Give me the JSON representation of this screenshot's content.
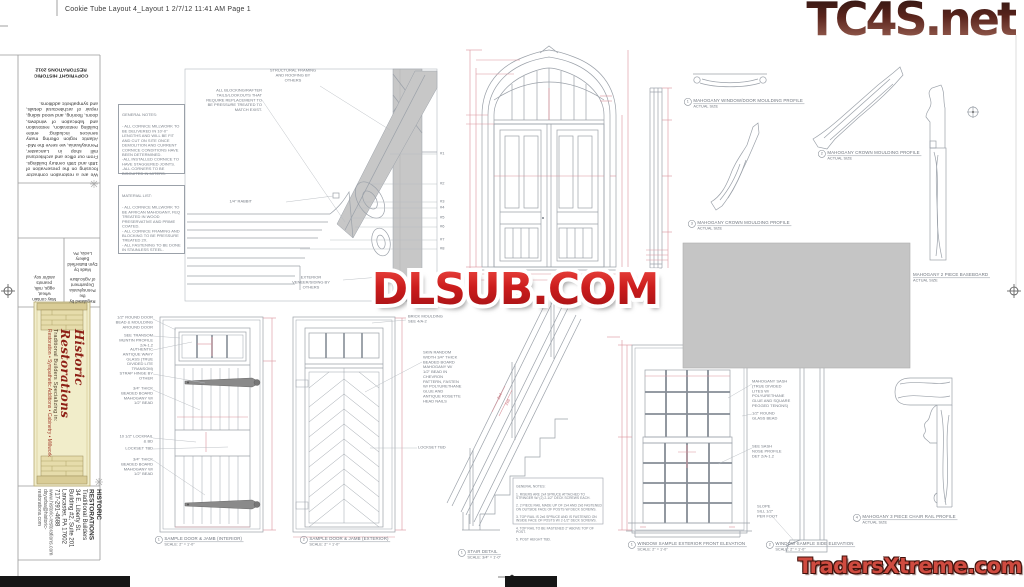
{
  "page": {
    "header": "Cookie Tube Layout 4_Layout 1  2/7/12  11:41 AM  Page 1"
  },
  "watermarks": {
    "tc4s": "TC4S.net",
    "dlsub": "DLSUB.COM",
    "traders": "TradersXtreme.com"
  },
  "sidebar": {
    "copyright": "COPYRIGHT HISTORIC\nRESTORATIONS 2012",
    "about": "We are a restoration contractor focusing on the preservation of 18th and 19th century buildings. From our office and architectural mill shop in Lancaster, Pennsylvania, we serve the Mid-Atlantic region offering many services including: entire building restoration, restoration and fabrication of windows, doors, flooring, and wood siding, repair of architectural details, and sympathetic additions.",
    "made_by": "Made by\nDym Butterfield Bakery\nLeola, PA",
    "regulated": "Regulated by the\nPennsylvania Department\nof Agriculture",
    "allergens": "May contain wheat,\neggs, milk, peanuts\nand/or soy.",
    "logo": {
      "title": "Historic Restorations",
      "subtitle1": "Traditional Builders Specializing in:",
      "subtitle2": "Restoration • Sympathetic Additions • Cabinetry • Millwork"
    },
    "address": {
      "line1": "HISTORIC RESTORATIONS",
      "line2": "Traditional Builders",
      "line3": "34 E. Liberty St.",
      "line4": "Building #2, Suite 201",
      "line5": "Lancaster, PA 17602",
      "line6": "717-291-4688",
      "line7": "www.historic-restorations.com",
      "line8": "dsyurba@historic-restorations.com"
    }
  },
  "notes": {
    "general": {
      "title": "GENERAL NOTES:",
      "body": "- ALL CORNICE MILLWORK TO BE DELIVERED IN 10'-0\" LENGTHS AND WILL BE FIT AND CUT ON SITE ONCE DEMOLITION AND CURRENT CORNICE CONDITIONS HAVE BEEN DETERMINED.\n-ALL INSTALLED CORNICE TO HAVE STAGGERED JOINTS.\n-ALL CORNERS TO BE BISCUITED IN MITERS."
    },
    "material": {
      "title": "MATERIAL LIST:",
      "body": "- ALL CORNICE MILLWORK TO BE AFRICAN MAHOGANY, FEQ TREATED IN WOOD PRESERVATIVE AND PRIME COATED.\n- ALL CORNICE FRAMING AND BLOCKING TO BE PRESSURE TREATED 2X.\n- ALL FASTENING TO BE DONE IN STAINLESS STEEL."
    }
  },
  "cornice": {
    "structural": "STRUCTURAL FRAMING\nAND ROOFING BY\nOTHERS",
    "blocking": "ALL BLOCKING/RAFTER\nTAILS/LOOKOUTS THAT\nREQUIRE REPLACEMENT TO\nBE PRESSURE TREATED TO\nMATCH EXIST.",
    "rabbit": "1/4\" RABBIT",
    "veneer": "EXTERIOR\nVENEER/SIDING BY\nOTHERS",
    "callouts": [
      "#1",
      "#2",
      "#3",
      "#4",
      "#5",
      "#6",
      "#7",
      "#8"
    ]
  },
  "profiles": {
    "p1": {
      "num": "1",
      "title": "MAHOGANY WINDOW/DOOR MOULDING PROFILE",
      "sub": "ACTUAL SIZE"
    },
    "p2": {
      "num": "2",
      "title": "MAHOGANY CROWN MOULDING PROFILE",
      "sub": "ACTUAL SIZE"
    },
    "p3": {
      "num": "3",
      "title": "MAHOGANY CROWN MOULDING PROFILE",
      "sub": "ACTUAL SIZE"
    },
    "baseboard": {
      "title": "MAHOGANY 2 PIECE BASEBOARD",
      "sub": "ACTUAL SIZE"
    },
    "chair": {
      "num": "4",
      "title": "MAHOGANY 3 PIECE CHAIR RAIL PROFILE",
      "sub": "ACTUAL SIZE"
    }
  },
  "door1": {
    "labels": {
      "l1": "1/2\" ROUND DOOR\nBEAD & MOULDING\nAROUND DOOR",
      "l2": "SEE TRANSOM\nMUNTIN PROFILE\n2/A-1.2",
      "l3": "AUTHENTIC\nANTIQUE WAVY\nGLASS (TRUE\nDIVIDED LITE\nTRANSOM)",
      "l4": "STRAP HINGE BY\nOTHER",
      "l5": "3/4\" THICK\nBEADED BOARD\nMAHOGANY W/\n1/2\" BEAD",
      "l6": "10 1/2\" LOCKRAIL\n& BD",
      "l7": "LOCKSET TBD",
      "l8": "3/4\" THICK\nBEADED BOARD\nMAHOGANY W/\n1/2\" BEAD"
    },
    "caption": {
      "num": "1",
      "title": "SAMPLE DOOR & JAMB (INTERIOR)",
      "scale": "SCALE: 2\" = 1'-0\""
    }
  },
  "door2": {
    "labels": {
      "brick": "BRICK MOULDING\nSEE 4/A-2",
      "skin": "SKIN RANDOM\nWIDTH 3/4\" THICK\nBEADED BOARD\nMAHOGANY W/\n1/2\" BEAD IN\nCHEVRON\nPATTERN, FASTEN\nW/ POLYURETHANE\nGLUE AND\nANTIQUE ROSETTE\nHEAD NAILS",
      "lockset": "LOCKSET TBD"
    },
    "caption": {
      "num": "2",
      "title": "SAMPLE DOOR & JAMB (EXTERIOR)",
      "scale": "SCALE: 2\" = 1'-0\""
    }
  },
  "stair": {
    "notes_title": "GENERAL NOTES:",
    "notes": [
      "1. RISERS ARE 2x4 SPRUCE ATTACHED TO STRINGER W/ (2) 2-1/2\" DECK SCREWS EACH.",
      "2. 2 PIECE RAIL MADE UP OF 2x4 AND 2x6 FASTENED ON OUTSIDE FACE OF POSTS W/ DECK SCREWS.",
      "3. TOP RAIL IS 2x6 SPRUCE AND IS FASTENED ON INSIDE FACE OF POSTS W/ 2-1/2\" DECK SCREWS.",
      "4. TOP RAIL TO BE FASTENED 2\" ABOVE TOP OF POST.",
      "5. POST HEIGHT TBD."
    ],
    "dim1": "2x4",
    "dim2": "2x6",
    "caption": {
      "num": "1",
      "title": "STAIR DETAIL",
      "scale": "SCALE: 3/4\" = 1'-0\""
    }
  },
  "window": {
    "labels": {
      "sash": "MAHOGANY SASH\n(TRUE DIVIDED\nLITES W/\nPOLYURETHANE\nGLUE AND SQUARE\nPEGGED TENONS)",
      "bead": "1/2\" ROUND\nGLASS BEAD",
      "profile": "SEE SASH\nNOSE PROFILE\nDET 2/A-1.2",
      "sill": "SLOPE\nSILL 1/2\"\nPER FOOT"
    },
    "front_caption": {
      "num": "1",
      "title": "WINDOW SAMPLE EXTERIOR FRONT ELEVATION",
      "scale": "SCALE: 2\" = 1'-0\""
    },
    "side_caption": {
      "num": "2",
      "title": "WINDOW SAMPLE SIDE ELEVATION",
      "scale": "SCALE: 2\" = 1'-0\""
    }
  }
}
